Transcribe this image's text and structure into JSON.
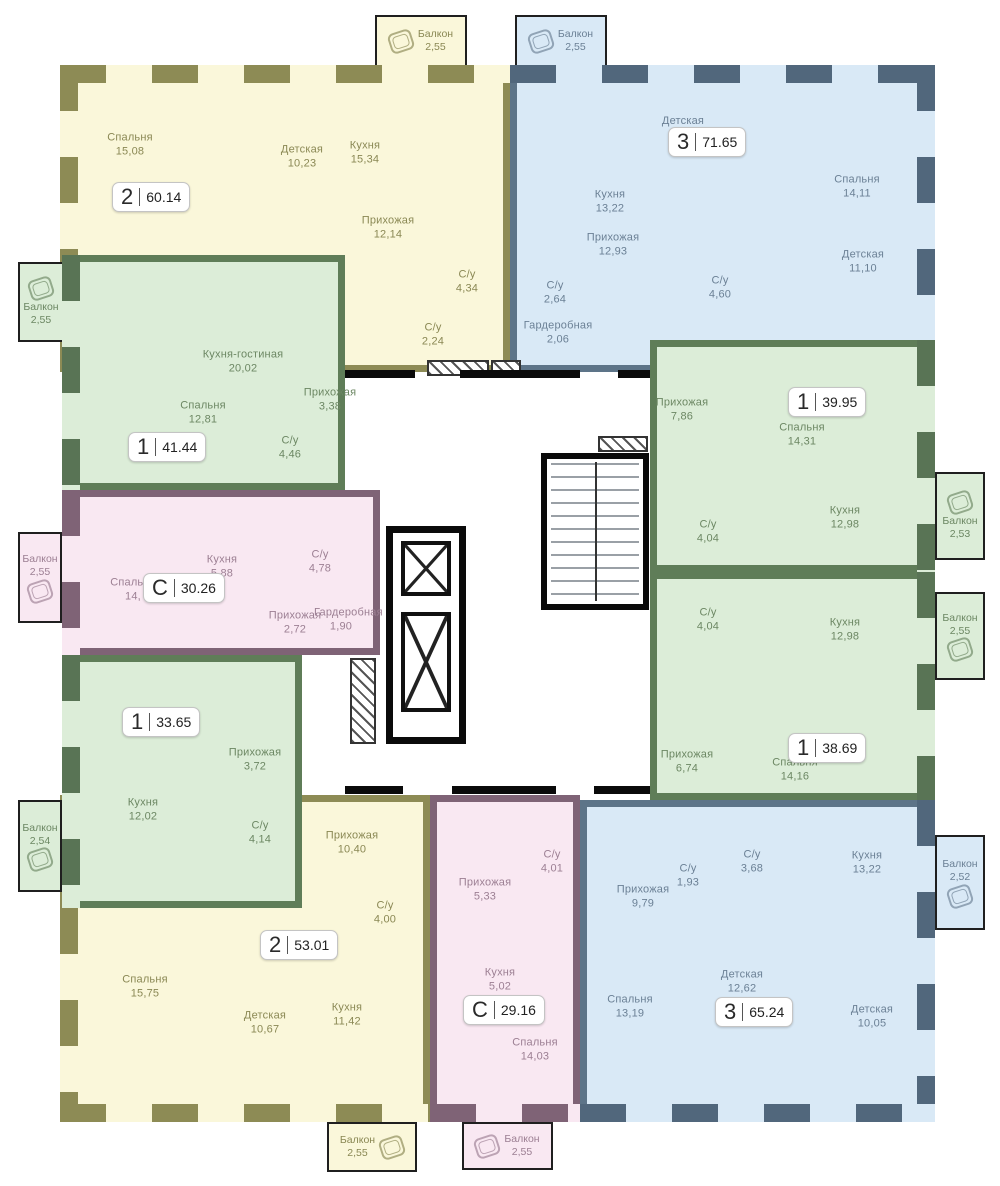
{
  "colors": {
    "yellow_fill": "#FAF7DA",
    "yellow_wall": "#8D8B55",
    "blue_fill": "#D9E9F6",
    "blue_wall": "#5D7488",
    "green_fill": "#DCEDD8",
    "green_wall": "#5F7D58",
    "pink_fill": "#F9E8F2",
    "pink_wall": "#7F6376"
  },
  "apartments": [
    {
      "type": "2",
      "total_area": "60.14",
      "color": "yellow",
      "rooms": [
        {
          "name": "Спальня",
          "area": "15,08"
        },
        {
          "name": "Детская",
          "area": "10,23"
        },
        {
          "name": "Кухня",
          "area": "15,34"
        },
        {
          "name": "Прихожая",
          "area": "12,14"
        },
        {
          "name": "С/у",
          "area": "4,34"
        },
        {
          "name": "С/у",
          "area": "2,24"
        }
      ]
    },
    {
      "type": "3",
      "total_area": "71.65",
      "color": "blue",
      "rooms": [
        {
          "name": "Детская",
          "area": ""
        },
        {
          "name": "Кухня",
          "area": "13,22"
        },
        {
          "name": "Прихожая",
          "area": "12,93"
        },
        {
          "name": "Спальня",
          "area": "14,11"
        },
        {
          "name": "Детская",
          "area": "11,10"
        },
        {
          "name": "С/у",
          "area": "2,64"
        },
        {
          "name": "С/у",
          "area": "4,60"
        },
        {
          "name": "Гардеробная",
          "area": "2,06"
        }
      ]
    },
    {
      "type": "1",
      "total_area": "41.44",
      "color": "green",
      "rooms": [
        {
          "name": "Кухня-гостиная",
          "area": "20,02"
        },
        {
          "name": "Спальня",
          "area": "12,81"
        },
        {
          "name": "Прихожая",
          "area": "3,38"
        },
        {
          "name": "С/у",
          "area": "4,46"
        }
      ]
    },
    {
      "type": "1",
      "total_area": "39.95",
      "color": "green",
      "rooms": [
        {
          "name": "Прихожая",
          "area": "7,86"
        },
        {
          "name": "Спальня",
          "area": "14,31"
        },
        {
          "name": "Кухня",
          "area": "12,98"
        },
        {
          "name": "С/у",
          "area": "4,04"
        }
      ]
    },
    {
      "type": "С",
      "total_area": "30.26",
      "color": "pink",
      "rooms": [
        {
          "name": "Спальня",
          "area": "14,"
        },
        {
          "name": "Кухня",
          "area": "5,88"
        },
        {
          "name": "С/у",
          "area": "4,78"
        },
        {
          "name": "Прихожая",
          "area": "2,72"
        },
        {
          "name": "Гардеробная",
          "area": "1,90"
        }
      ]
    },
    {
      "type": "1",
      "total_area": "33.65",
      "color": "green",
      "rooms": [
        {
          "name": "Прихожая",
          "area": "3,72"
        },
        {
          "name": "Кухня",
          "area": "12,02"
        },
        {
          "name": "С/у",
          "area": "4,14"
        }
      ]
    },
    {
      "type": "1",
      "total_area": "38.69",
      "color": "green",
      "rooms": [
        {
          "name": "С/у",
          "area": "4,04"
        },
        {
          "name": "Кухня",
          "area": "12,98"
        },
        {
          "name": "Прихожая",
          "area": "6,74"
        },
        {
          "name": "Спальня",
          "area": "14,16"
        }
      ]
    },
    {
      "type": "2",
      "total_area": "53.01",
      "color": "yellow",
      "rooms": [
        {
          "name": "Прихожая",
          "area": "10,40"
        },
        {
          "name": "С/у",
          "area": "4,00"
        },
        {
          "name": "Спальня",
          "area": "15,75"
        },
        {
          "name": "Детская",
          "area": "10,67"
        },
        {
          "name": "Кухня",
          "area": "11,42"
        }
      ]
    },
    {
      "type": "С",
      "total_area": "29.16",
      "color": "pink",
      "rooms": [
        {
          "name": "Прихожая",
          "area": "5,33"
        },
        {
          "name": "С/у",
          "area": "4,01"
        },
        {
          "name": "Кухня",
          "area": "5,02"
        },
        {
          "name": "Спальня",
          "area": "14,03"
        }
      ]
    },
    {
      "type": "3",
      "total_area": "65.24",
      "color": "blue",
      "rooms": [
        {
          "name": "Прихожая",
          "area": "9,79"
        },
        {
          "name": "С/у",
          "area": "1,93"
        },
        {
          "name": "С/у",
          "area": "3,68"
        },
        {
          "name": "Кухня",
          "area": "13,22"
        },
        {
          "name": "Спальня",
          "area": "13,19"
        },
        {
          "name": "Детская",
          "area": "12,62"
        },
        {
          "name": "Детская",
          "area": "10,05"
        }
      ]
    }
  ],
  "balconies": [
    {
      "name": "Балкон",
      "area": "2,55",
      "color": "yellow"
    },
    {
      "name": "Балкон",
      "area": "2,55",
      "color": "blue"
    },
    {
      "name": "Балкон",
      "area": "2,55",
      "color": "green"
    },
    {
      "name": "Балкон",
      "area": "2,55",
      "color": "pink"
    },
    {
      "name": "Балкон",
      "area": "2,54",
      "color": "green"
    },
    {
      "name": "Балкон",
      "area": "2,53",
      "color": "green"
    },
    {
      "name": "Балкон",
      "area": "2,55",
      "color": "green"
    },
    {
      "name": "Балкон",
      "area": "2,52",
      "color": "blue"
    },
    {
      "name": "Балкон",
      "area": "2,55",
      "color": "yellow"
    },
    {
      "name": "Балкон",
      "area": "2,55",
      "color": "pink"
    }
  ]
}
